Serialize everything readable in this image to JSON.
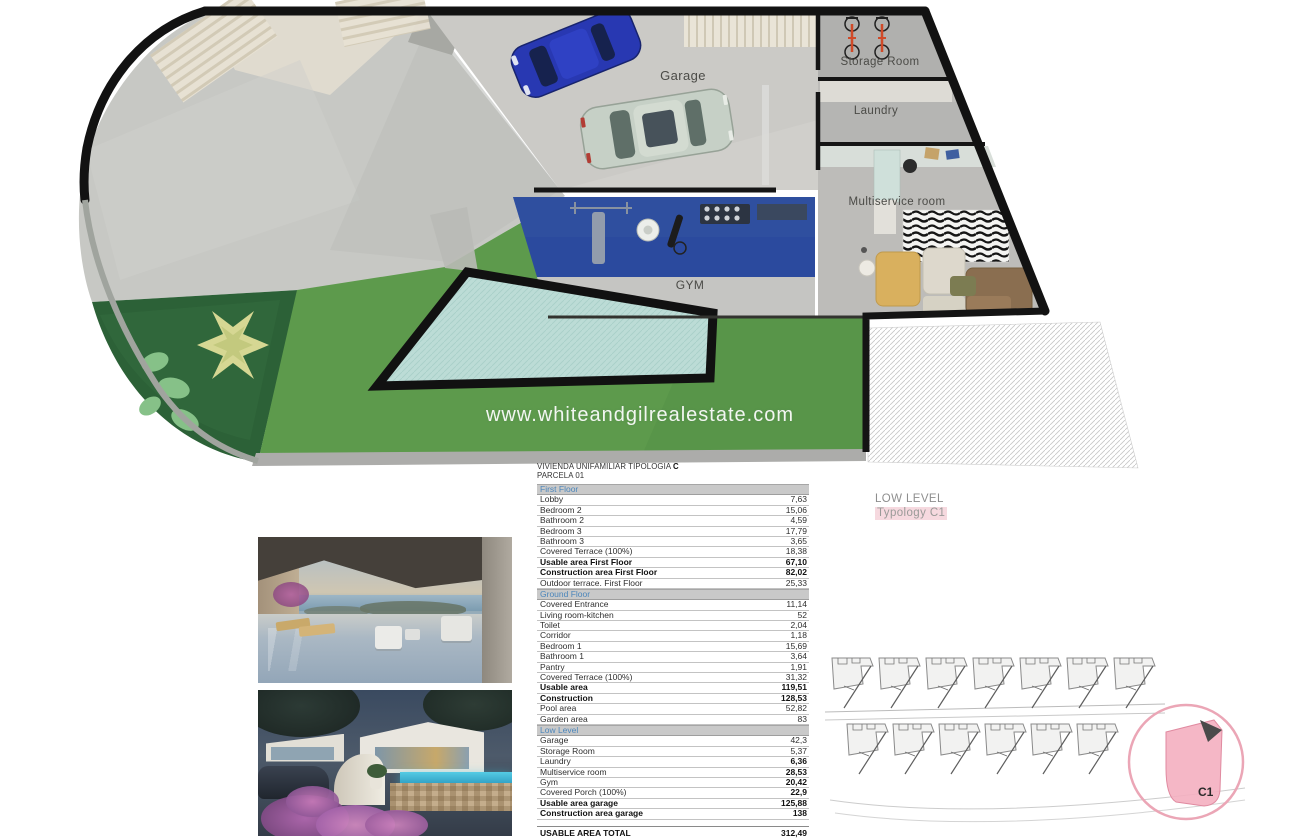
{
  "watermark": "www.whiteandgilrealestate.com",
  "plan": {
    "labels": {
      "garage": "Garage",
      "storage": "Storage Room",
      "laundry": "Laundry",
      "multiservice": "Multiservice room",
      "gym": "GYM"
    }
  },
  "level_label": {
    "line1": "LOW LEVEL",
    "line2": "Typology C1"
  },
  "site_plan": {
    "unit": "C1"
  },
  "table": {
    "title": "VIVIENDA UNIFAMILIAR TIPOLOGIA",
    "title_bold": "C",
    "subtitle": "PARCELA 01",
    "sections": [
      {
        "header": "First Floor",
        "rows": [
          {
            "label": "Lobby",
            "value": "7,63"
          },
          {
            "label": "Bedroom 2",
            "value": "15,06"
          },
          {
            "label": "Bathroom 2",
            "value": "4,59"
          },
          {
            "label": "Bedroom 3",
            "value": "17,79"
          },
          {
            "label": "Bathroom 3",
            "value": "3,65"
          },
          {
            "label": "Covered Terrace (100%)",
            "value": "18,38"
          },
          {
            "label": "Usable area First Floor",
            "value": "67,10",
            "bold": true
          },
          {
            "label": "Construction area First Floor",
            "value": "82,02",
            "bold": true
          },
          {
            "label": "Outdoor terrace. First Floor",
            "value": "25,33"
          }
        ]
      },
      {
        "header": "Ground Floor",
        "rows": [
          {
            "label": "Covered Entrance",
            "value": "11,14"
          },
          {
            "label": "Living room-kitchen",
            "value": "52"
          },
          {
            "label": "Toilet",
            "value": "2,04"
          },
          {
            "label": "Corridor",
            "value": "1,18"
          },
          {
            "label": "Bedroom 1",
            "value": "15,69"
          },
          {
            "label": "Bathroom 1",
            "value": "3,64"
          },
          {
            "label": "Pantry",
            "value": "1,91"
          },
          {
            "label": "Covered Terrace (100%)",
            "value": "31,32"
          },
          {
            "label": "Usable area",
            "value": "119,51",
            "bold": true
          },
          {
            "label": "Construction",
            "value": "128,53",
            "bold": true
          },
          {
            "label": "Pool area",
            "value": "52,82"
          },
          {
            "label": "Garden area",
            "value": "83"
          }
        ]
      },
      {
        "header": "Low Level",
        "rows": [
          {
            "label": "Garage",
            "value": "42,3"
          },
          {
            "label": "Storage Room",
            "value": "5,37"
          },
          {
            "label": "Laundry",
            "value": "6,36",
            "value_bold": true
          },
          {
            "label": "Multiservice room",
            "value": "28,53",
            "value_bold": true
          },
          {
            "label": "Gym",
            "value": "20,42",
            "value_bold": true
          },
          {
            "label": "Covered Porch (100%)",
            "value": "22,9",
            "value_bold": true
          },
          {
            "label": "Usable area garage",
            "value": "125,88",
            "bold": true
          },
          {
            "label": "Construction area garage",
            "value": "138",
            "bold": true
          }
        ]
      }
    ],
    "total": {
      "label": "USABLE AREA TOTAL",
      "value": "312,49"
    }
  },
  "colors": {
    "section_header_text": "#4c86bb",
    "section_header_bg": "#c9c9c9",
    "gym_floor": "#2b4a9e",
    "lawn": "#5d9a4c",
    "garden_bed": "#2c6137",
    "pool_water": "#bcdcd6",
    "plan_wall": "#141414",
    "typology_highlight": "#f6d9df",
    "site_unit_highlight": "#f4afc0"
  }
}
